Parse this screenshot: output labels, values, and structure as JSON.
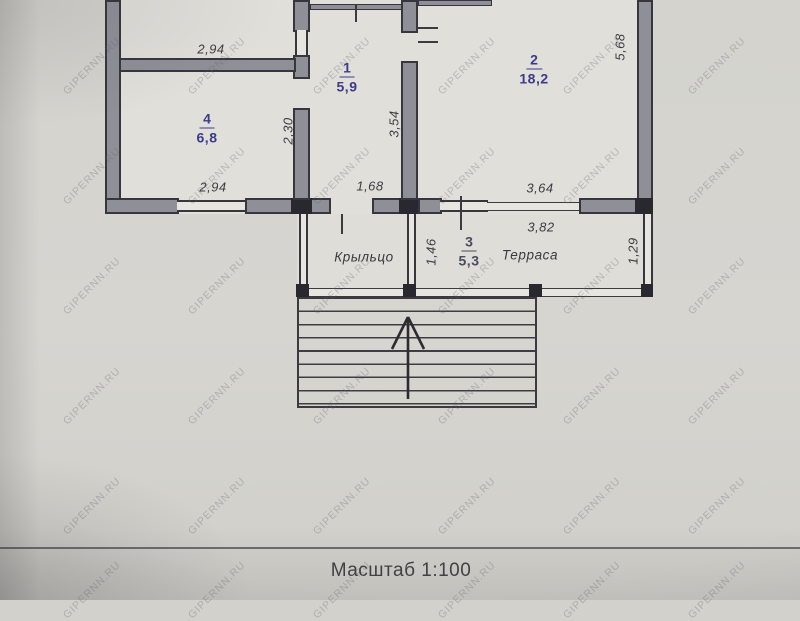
{
  "floorplan": {
    "rooms": [
      {
        "number": "1",
        "area": "5,9"
      },
      {
        "number": "2",
        "area": "18,2"
      },
      {
        "number": "3",
        "area": "5,3"
      },
      {
        "number": "4",
        "area": "6,8"
      }
    ],
    "labels": {
      "porch": "Крыльцо",
      "terrace": "Терраса"
    },
    "dimensions": {
      "upper_room_width": "2,94",
      "room4_width": "2,94",
      "room4_depth": "2,30",
      "room1_depth": "3,54",
      "room1_width": "1,68",
      "room2_width": "3,64",
      "room2_depth": "5,68",
      "terrace_width": "3,82",
      "porch_depth": "1,46",
      "terrace_depth": "1,29"
    }
  },
  "footer": {
    "scale_label": "Масштаб 1:100"
  },
  "watermark": {
    "text": "GIPERNN.RU"
  }
}
